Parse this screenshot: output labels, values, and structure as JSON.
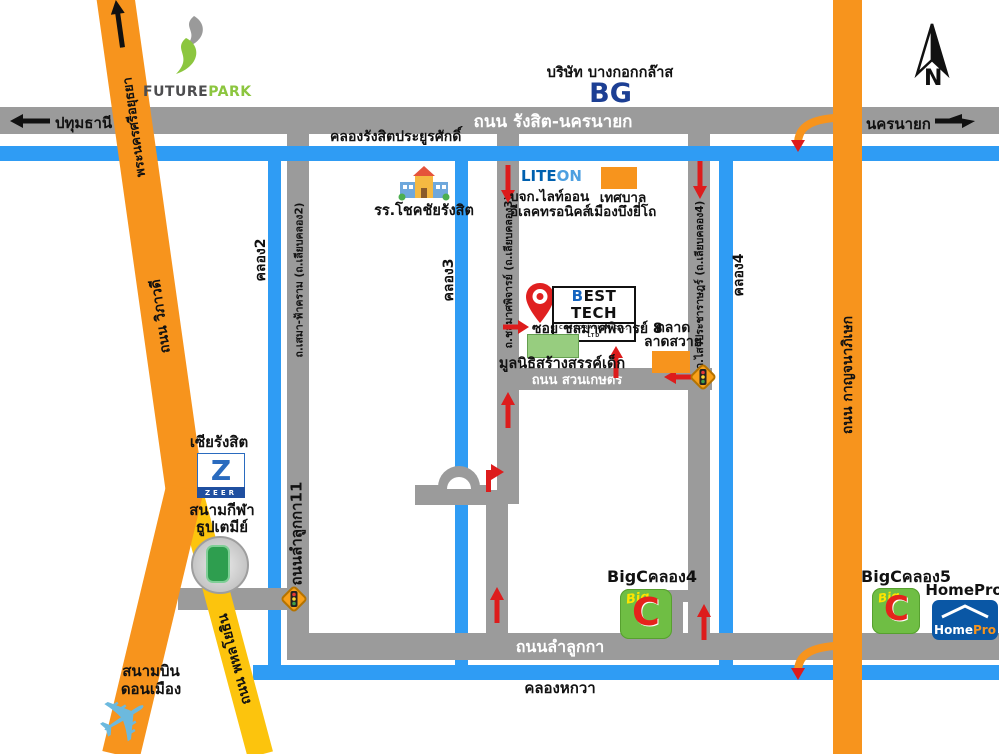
{
  "compass": {
    "north_label": "N"
  },
  "colors": {
    "road_gray": "#9b9b9b",
    "canal_blue": "#2f9cf4",
    "highway_orange": "#f7941d",
    "highway_yellow": "#fcc40d",
    "arrow_red": "#dd1c1c"
  },
  "highways": {
    "rangsit_nakhonnayok": "ถนน รังสิต-นครนายก",
    "dest_left": "ปทุมธานี",
    "dest_right": "นครนายก",
    "dest_top": "พระนครศรีอยุธยา",
    "vibhavadi": "ถนน วิภาวดี",
    "phahonyothin": "ถนน พหลโยธิน",
    "kanchanaphisek": "ถนน กาญจนาภิเษก",
    "suan_kaset": "ถนน สวนเกษตร",
    "lamlukka": "ถนนลำลูกกา",
    "lamlukka11": "ถนนลำลูกกา11",
    "sema_fakram": "ถ.เสมา-ฟ้าคราม (ถ.เลียบคลอง2)",
    "chonlamat": "ถ.ชลมาศพิจารย์ (ถ.เลียบคลอง3)",
    "sawai_pracharat": "ถ.ไสวประชาราษฎร์ (ถ.เลียบคลอง4)",
    "soi_chonlamat8": "ซอย ชลมาศพิจารย์ 8"
  },
  "canals": {
    "rangsit_prayurasak": "คลองรังสิตประยูรศักดิ์",
    "khlong2": "คลอง2",
    "khlong3": "คลอง3",
    "khlong4": "คลอง4",
    "hokwa": "คลองหกวา"
  },
  "places": {
    "future_park": {
      "future": "FUTURE",
      "park": "PARK"
    },
    "bangkok_glass": {
      "name": "บริษัท บางกอกกล๊าส",
      "logo": "BG"
    },
    "school": {
      "name": "รร.โชคชัยรังสิต"
    },
    "liteon": {
      "logo_lite": "LITE",
      "logo_on": "ON",
      "line1": "บจก.ไลท์ออน",
      "line2": "อีเลคทรอนิคส์"
    },
    "municipality": {
      "line1": "เทศบาล",
      "line2": "เมืองบึงยี่โถ"
    },
    "best_tech": {
      "b": "B",
      "rest": "EST TECH",
      "sub": "CORPORATION CO., LTD"
    },
    "foundation": {
      "name": "มูลนิธิสร้างสรรค์เด็ก"
    },
    "market": {
      "line1": "ตลาด",
      "line2": "ลาดสวาย"
    },
    "zeer": {
      "name": "เซียรังสิต",
      "z": "Z",
      "zeer": "ZEER"
    },
    "stadium": {
      "line1": "สนามกีฬา",
      "line2": "ธูปเตมีย์"
    },
    "airport": {
      "line1": "สนามบิน",
      "line2": "ดอนเมือง"
    },
    "bigc_khlong4": {
      "label": "BigCคลอง4"
    },
    "bigc_khlong5": {
      "label": "BigCคลอง5"
    },
    "bigc_logo": {
      "big": "Big",
      "c": "C"
    },
    "homepro": {
      "label": "HomePro",
      "home": "Home",
      "pro": "Pro"
    }
  }
}
